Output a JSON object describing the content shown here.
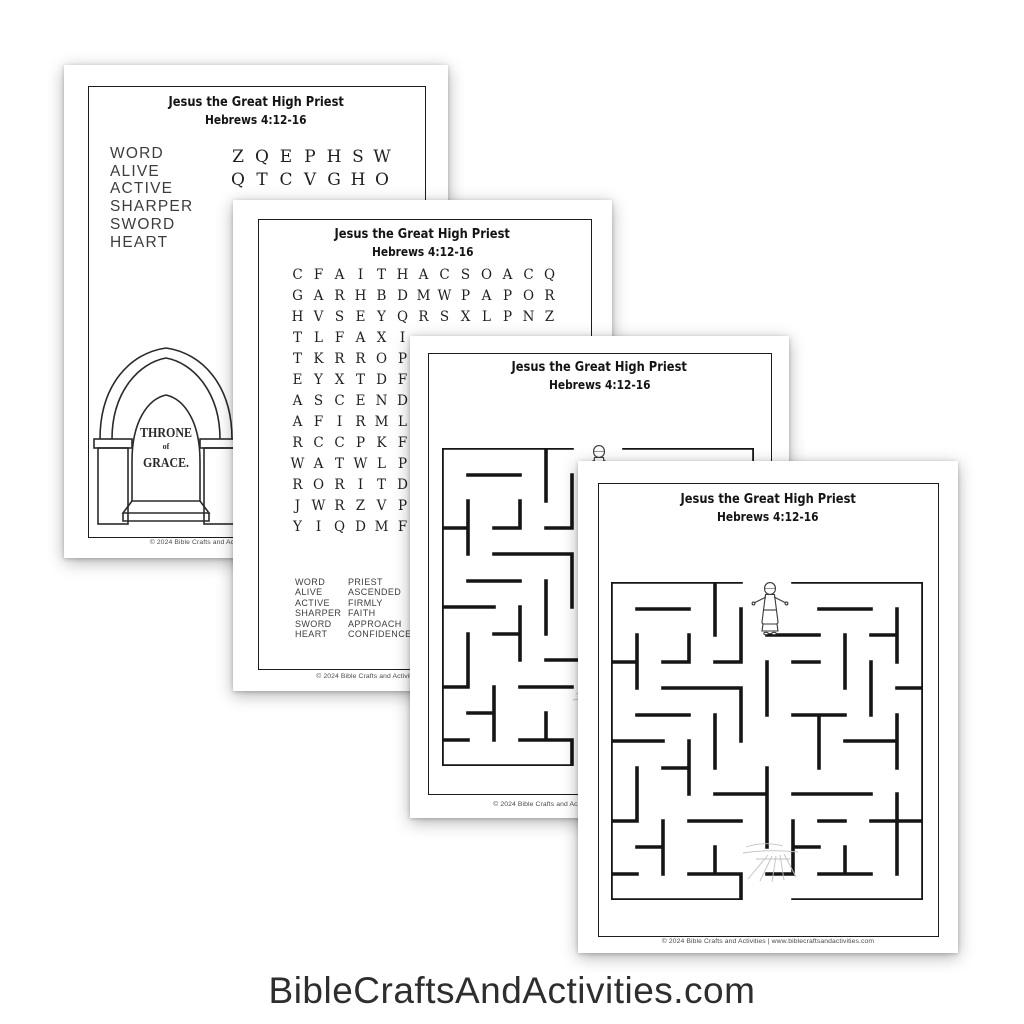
{
  "site": {
    "text": "BibleCraftsAndActivities.com"
  },
  "shared": {
    "title": "Jesus the Great High Priest",
    "subtitle": "Hebrews 4:12-16",
    "footer": "© 2024 Bible Crafts and Activities | www.biblecraftsandactivities.com"
  },
  "wordsearch_easy": {
    "words": [
      "WORD",
      "ALIVE",
      "ACTIVE",
      "SHARPER",
      "SWORD",
      "HEART"
    ],
    "grid_rows": [
      "ZQEPHSW",
      "QTCVGHO"
    ],
    "throne": {
      "line1": "THRONE",
      "line2": "of",
      "line3": "GRACE."
    }
  },
  "wordsearch_full": {
    "grid_rows": [
      "CFAITHACSOACQ",
      "GARHBDMWPAPOR",
      "HVSEYQRSXLPNZ",
      "TLFAXI",
      "TKRROP",
      "EYXTDF",
      "ASCEND",
      "AFIRML",
      "RCCPKF",
      "WATWLP",
      "RORITD",
      "JWRZVP",
      "YIQDMF"
    ],
    "words_col1": [
      "WORD",
      "ALIVE",
      "ACTIVE",
      "SHARPER",
      "SWORD",
      "HEART"
    ],
    "words_col2": [
      "PRIEST",
      "ASCENDED",
      "FIRMLY",
      "FAITH",
      "APPROACH",
      "CONFIDENCE"
    ]
  }
}
